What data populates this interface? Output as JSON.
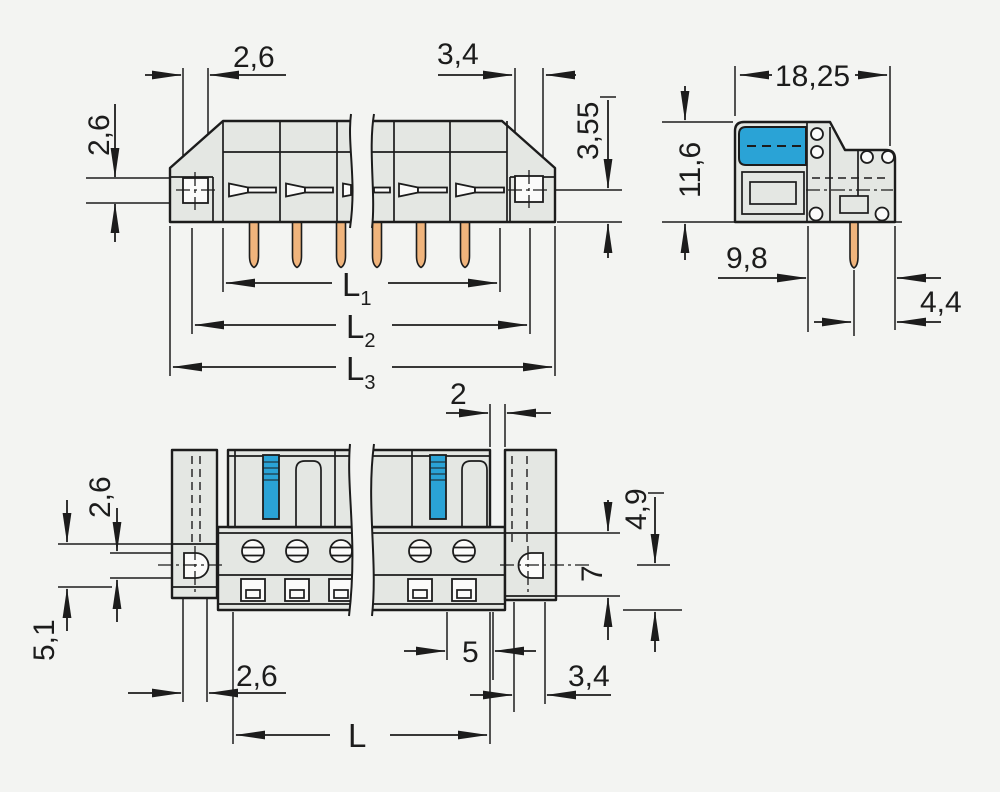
{
  "colors": {
    "lever_blue": "#2aa3d6",
    "pin_copper": "#f0b47c",
    "body_gray": "#e4e7e3",
    "line": "#1c1c1c",
    "background": "#f3f4f2"
  },
  "views": {
    "side": {
      "dims": {
        "flange_hole_width_left": "2,6",
        "flange_hole_width_right": "3,4",
        "flange_hole_height": "2,6",
        "pin_row_offset": "3,55",
        "l1": {
          "base": "L",
          "sub": "1"
        },
        "l2": {
          "base": "L",
          "sub": "2"
        },
        "l3": {
          "base": "L",
          "sub": "3"
        }
      }
    },
    "profile": {
      "dims": {
        "overall_depth": "18,25",
        "overall_height": "11,6",
        "body_depth": "9,8",
        "pin_to_edge": "4,4"
      }
    },
    "front": {
      "dims": {
        "end_gap": "2",
        "flange_hole_height": "2,6",
        "flange_ear_left": "5,1",
        "flange_hole_width_left": "2,6",
        "pole_pitch": "5",
        "flange_hole_width_right": "3,4",
        "flange_top_offset": "4,9",
        "flange_ear_right": "7",
        "length": "L"
      }
    }
  }
}
